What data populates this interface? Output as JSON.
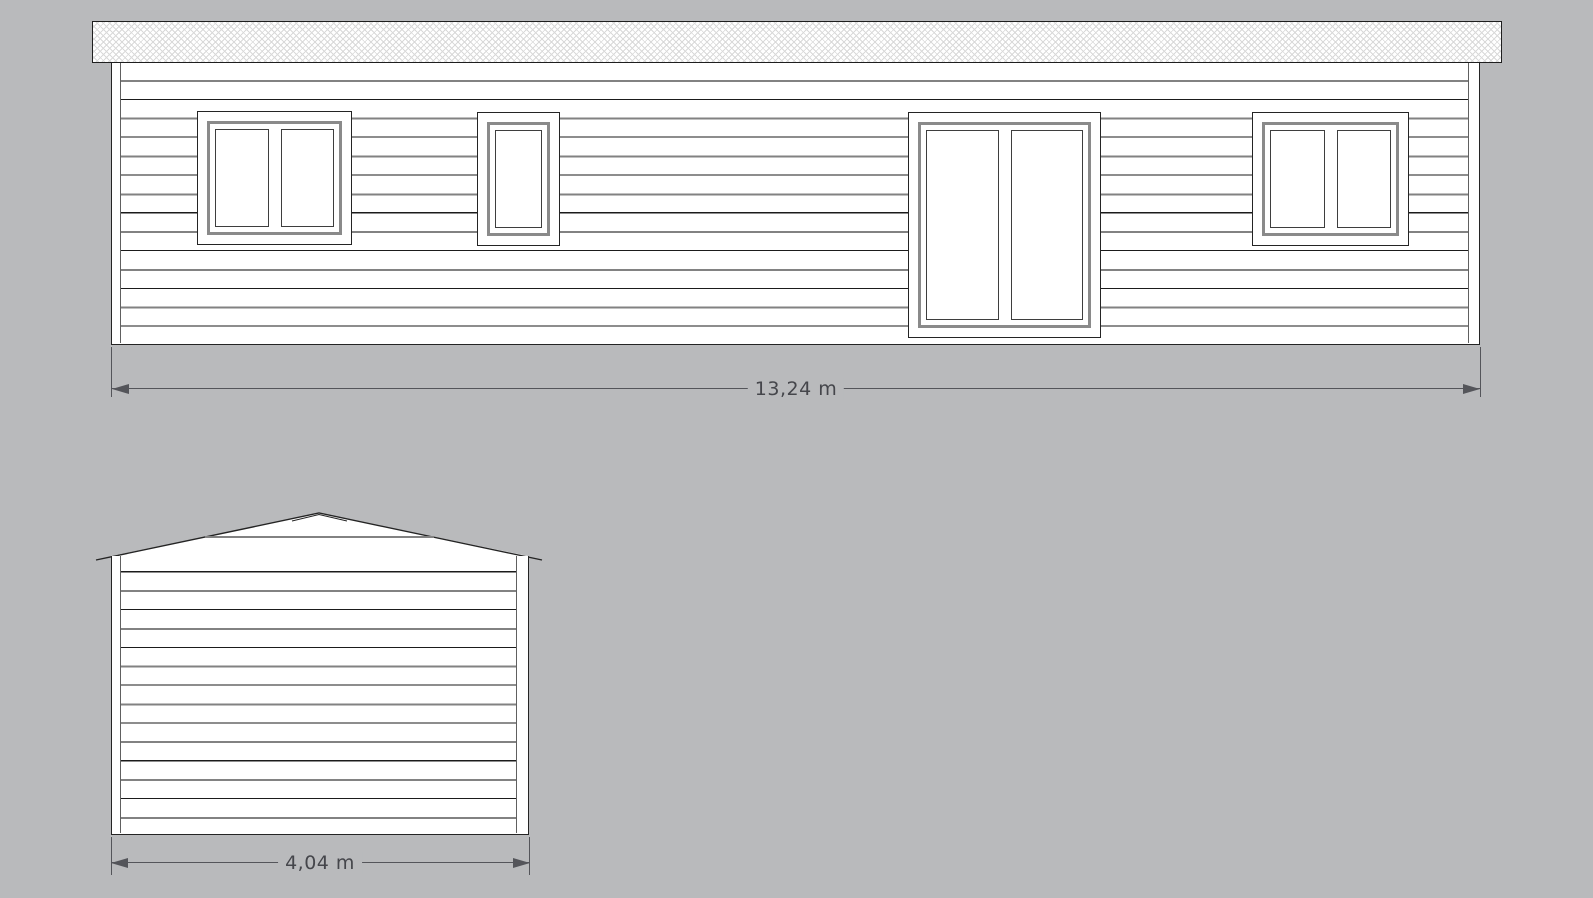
{
  "colors": {
    "background": "#b9babc",
    "outline": "#242424",
    "siding_line_dark": "#1b1b1b",
    "siding_line_gray": "#828282",
    "window_frame_gray": "#8a8a8a",
    "roof_hatch": "#d9d9d9",
    "dimension_line": "#54555a",
    "dimension_text": "#45464b"
  },
  "front_elevation": {
    "name": "front-elevation",
    "dimension_label": "13,24 m",
    "windows": [
      {
        "name": "double-casement-window"
      },
      {
        "name": "single-casement-window"
      },
      {
        "name": "double-glazed-door"
      },
      {
        "name": "double-casement-window"
      }
    ]
  },
  "end_elevation": {
    "name": "end-elevation-gable",
    "dimension_label": "4,04 m"
  }
}
